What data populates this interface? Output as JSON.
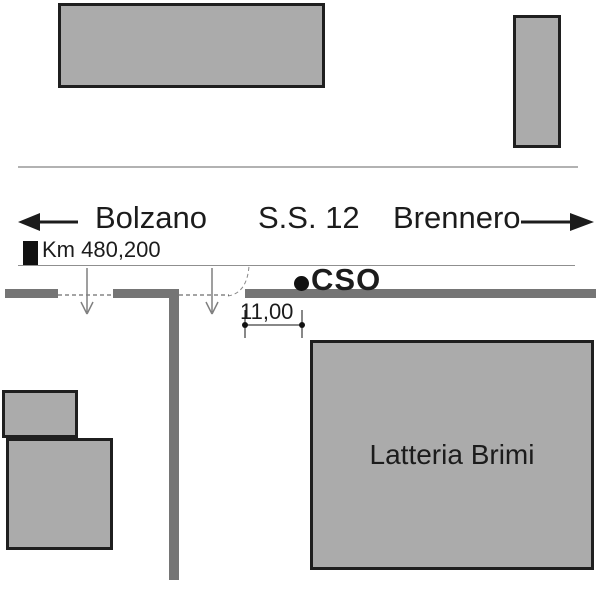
{
  "diagram": {
    "type": "road-site-plan",
    "road": {
      "route_label": "S.S. 12",
      "direction_left": "Bolzano",
      "direction_right": "Brennero",
      "km_label": "Km 480,200",
      "station_label": "CSO",
      "driveway_width": "11,00"
    },
    "buildings": {
      "main_label": "Latteria Brimi"
    },
    "colors": {
      "building_fill": "#ababab",
      "building_border": "#1f1f1f",
      "road_gray": "#757575",
      "boundary_line": "#b2b2b2",
      "edge_line": "#8f8f8f",
      "ink": "#1c1c1c",
      "arrow_gray": "#7f7f7f"
    }
  }
}
